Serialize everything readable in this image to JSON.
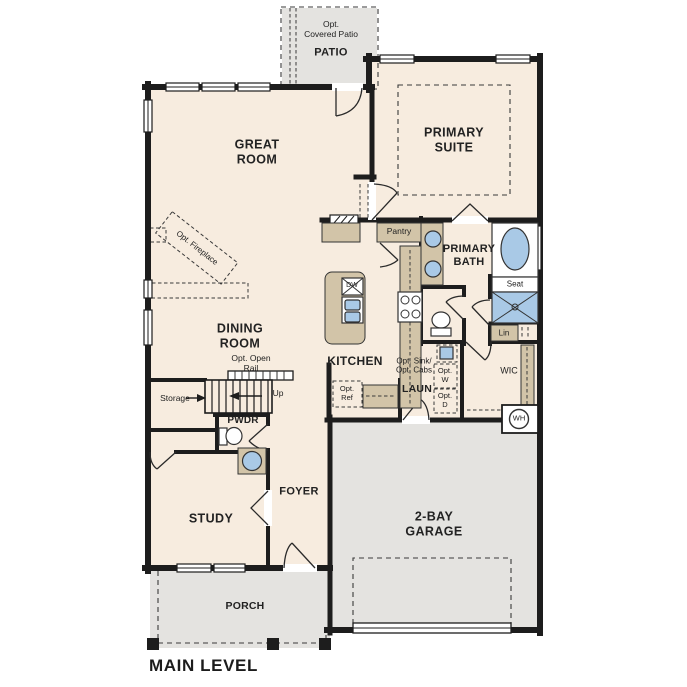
{
  "floor_plan": {
    "level_label": "MAIN LEVEL",
    "rooms": {
      "patio": {
        "optional_note": "Opt.\nCovered Patio",
        "name": "PATIO"
      },
      "great_room": {
        "name": "GREAT\nROOM"
      },
      "primary_suite": {
        "name": "PRIMARY\nSUITE"
      },
      "primary_bath": {
        "name": "PRIMARY\nBATH"
      },
      "dining_room": {
        "name": "DINING\nROOM"
      },
      "kitchen": {
        "name": "KITCHEN"
      },
      "laundry": {
        "name": "LAUN"
      },
      "wic": {
        "name": "WIC"
      },
      "powder": {
        "name": "PWDR"
      },
      "foyer": {
        "name": "FOYER"
      },
      "study": {
        "name": "STUDY"
      },
      "garage": {
        "name": "2-BAY\nGARAGE"
      },
      "porch": {
        "name": "PORCH"
      }
    },
    "annotations": {
      "opt_fireplace": "Opt. Fireplace",
      "pantry": "Pantry",
      "seat": "Seat",
      "linen": "Lin",
      "opt_open_rail": "Opt. Open\nRail",
      "opt_sink_cabs": "Opt. Sink/\nOpt. Cabs",
      "opt_washer": "Opt.\nW",
      "opt_dryer": "Opt.\nD",
      "opt_ref": "Opt.\nRef",
      "storage": "Storage",
      "up": "Up",
      "water_heater": "WH",
      "dishwasher": "DW"
    },
    "colors": {
      "interior": "#f7ecdf",
      "concrete": "#e4e3e0",
      "cabinet": "#d2c4a8",
      "fixture_blue": "#a9c9e6",
      "wall": "#1d1d1d",
      "text": "#222222"
    }
  }
}
